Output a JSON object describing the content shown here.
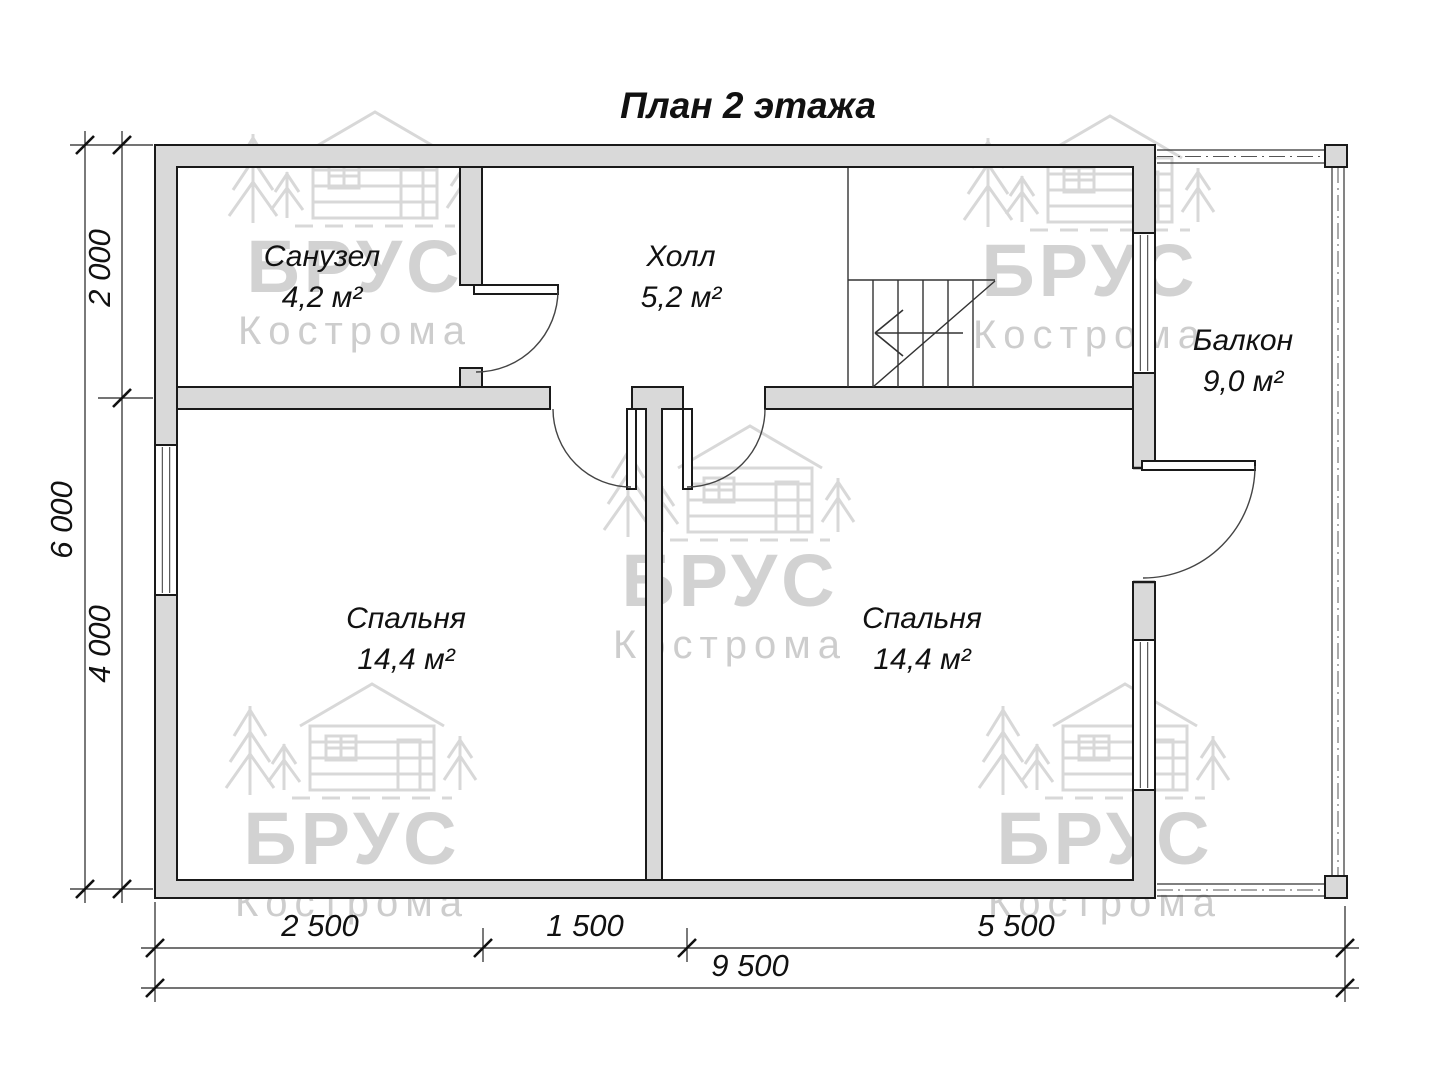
{
  "title": "План 2 этажа",
  "rooms": [
    {
      "name": "Санузел",
      "area": "4,2 м²"
    },
    {
      "name": "Холл",
      "area": "5,2 м²"
    },
    {
      "name": "Балкон",
      "area": "9,0 м²"
    },
    {
      "name": "Спальня",
      "area": "14,4 м²"
    },
    {
      "name": "Спальня",
      "area": "14,4 м²"
    }
  ],
  "dimensions": {
    "left": {
      "segment_top": "2 000",
      "segment_bottom": "4 000",
      "total": "6 000"
    },
    "bottom": {
      "segment_1": "2 500",
      "segment_2": "1 500",
      "segment_3": "5 500",
      "total": "9 500"
    }
  },
  "watermark": {
    "brand": "БРУС",
    "city": "Кострома"
  },
  "colors": {
    "wall_fill": "#d9d9d9",
    "outline": "#1a1a1a",
    "thin_line": "#333333",
    "watermark_gray": "#969696"
  }
}
